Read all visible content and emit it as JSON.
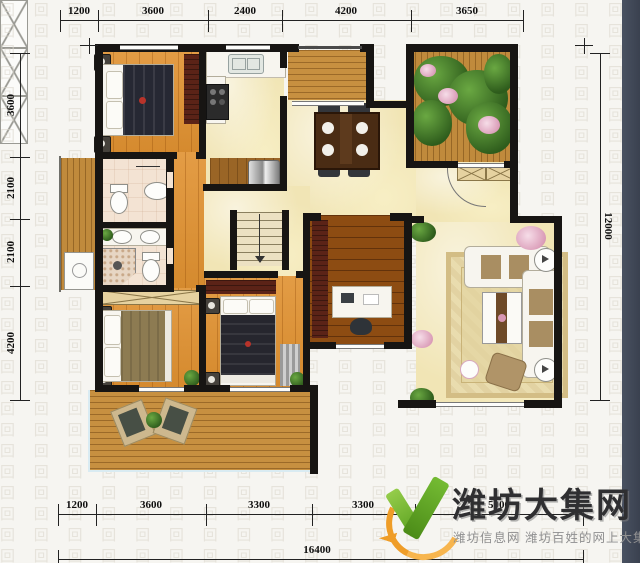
{
  "background": {
    "pattern_glyph": "回"
  },
  "dims": {
    "top": [
      "1200",
      "3600",
      "2400",
      "4200",
      "3650"
    ],
    "left": [
      "3600",
      "2100",
      "2100",
      "4200"
    ],
    "right": [
      "12000"
    ],
    "bottom": [
      "1200",
      "3600",
      "3300",
      "3300",
      "5000"
    ],
    "bottom_total": "16400"
  },
  "logo": {
    "title": "潍坊大集网",
    "tagline": "潍坊信息网 潍坊百姓的网上大集",
    "check_color": "#6ab22c",
    "swoosh_color": "#f0a02c",
    "title_color": "#2f2f31",
    "tagline_color": "#8f8f90"
  },
  "colors": {
    "wall": "#171513",
    "wood_floor": "#e09130",
    "dark_wood_floor": "#8d4c12",
    "deck_wood": "#c79040",
    "marble_cream": "#f1e5b5",
    "bath_tile": "#f3e3d3",
    "wardrobe_maroon": "#5b2317",
    "terrace_green": "#2e5c1c",
    "right_strip_slate": "#3a414f",
    "dimension_text": "#101010"
  }
}
